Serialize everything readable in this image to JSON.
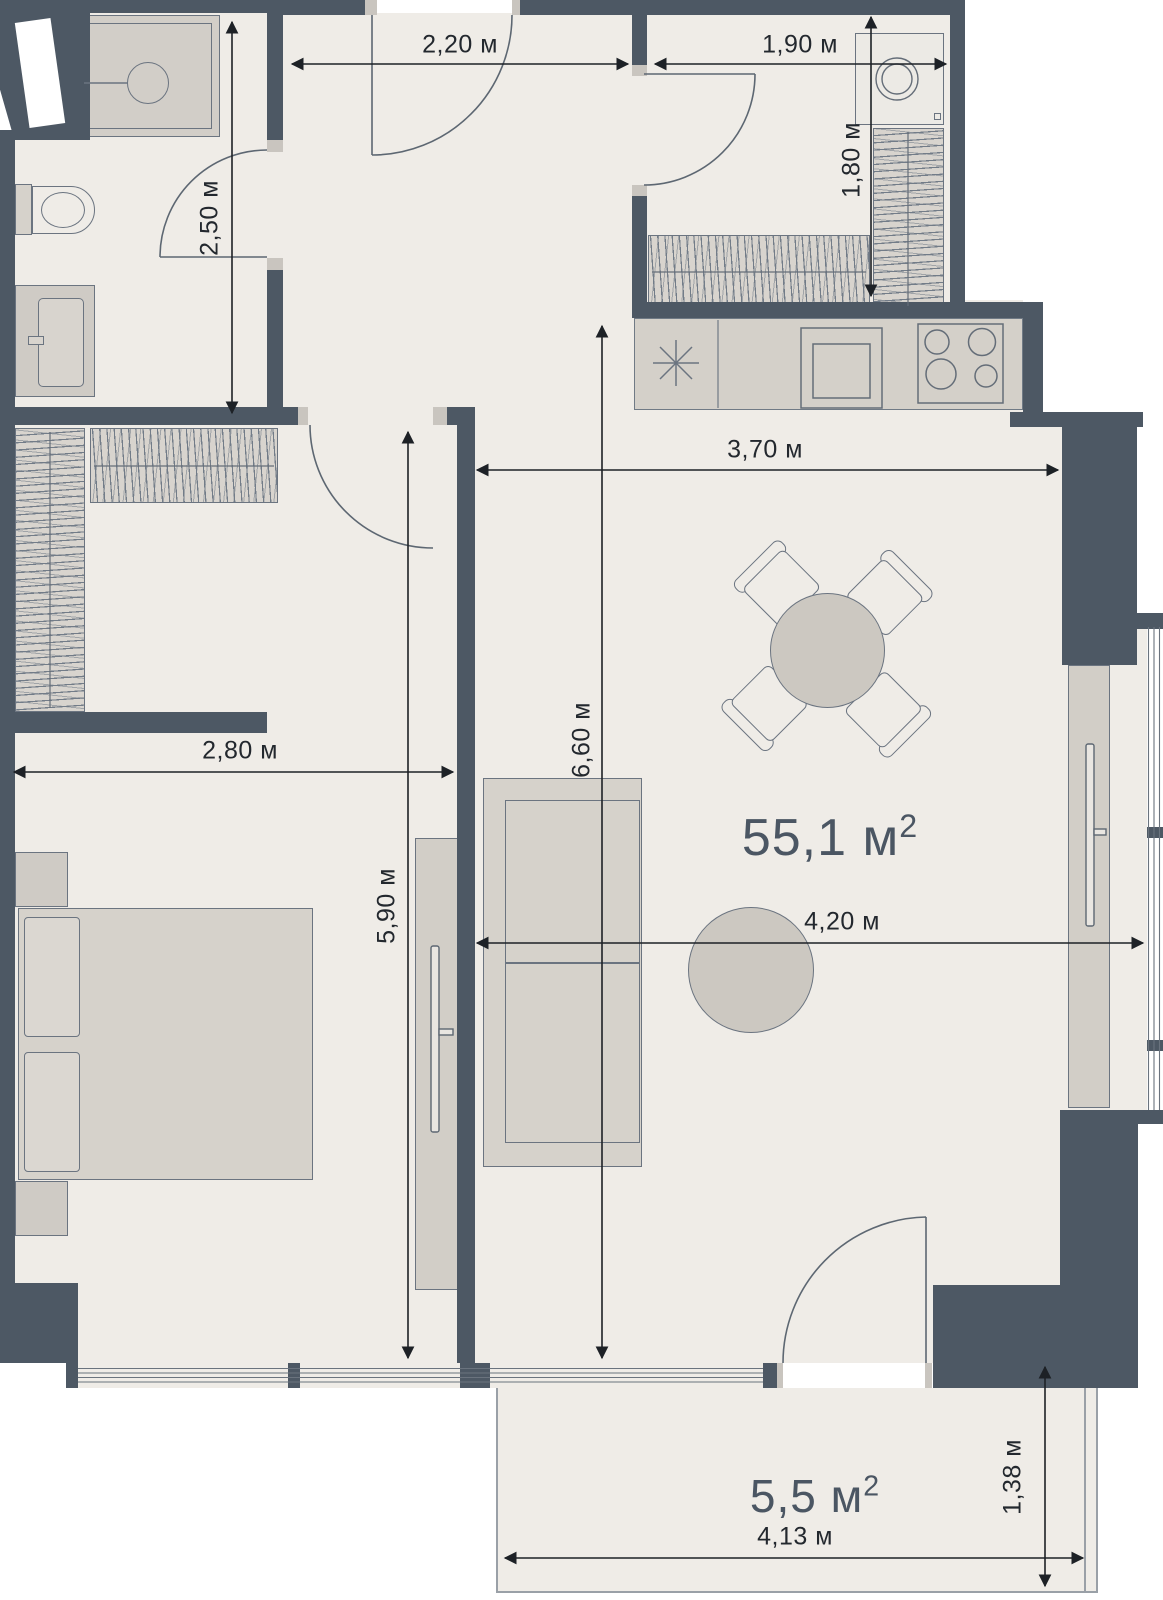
{
  "plan": {
    "title": "apartment-floor-plan",
    "area_labels": [
      {
        "id": "living-total-area",
        "text": "55,1 м",
        "sup": "2"
      },
      {
        "id": "balcony-area",
        "text": "5,5 м",
        "sup": "2"
      }
    ],
    "dimensions": [
      {
        "id": "hallway-width",
        "text": "2,20 м"
      },
      {
        "id": "laundry-width",
        "text": "1,90 м"
      },
      {
        "id": "bathroom-depth",
        "text": "2,50 м"
      },
      {
        "id": "laundry-depth",
        "text": "1,80 м"
      },
      {
        "id": "kitchen-width",
        "text": "3,70 м"
      },
      {
        "id": "living-depth",
        "text": "6,60 м"
      },
      {
        "id": "bedroom-width",
        "text": "2,80 м"
      },
      {
        "id": "bedroom-depth",
        "text": "5,90 м"
      },
      {
        "id": "living-width",
        "text": "4,20 м"
      },
      {
        "id": "balcony-width",
        "text": "4,13 м"
      },
      {
        "id": "balcony-depth",
        "text": "1,38 м"
      }
    ],
    "colors": {
      "wall": "#4d5864",
      "floor": "#efece7",
      "furniture_fill": "#d6d2cb",
      "label_text": "#4b5663",
      "dimension_text": "#23282e"
    },
    "icons": {
      "sink": "asterisk-star",
      "stove": "four-burner-circles",
      "shower": "square-with-round-head",
      "toilet": "tank-and-bowl",
      "washing_machine": "box-with-drum-circle",
      "wardrobe": "hatched-rail-strip",
      "door": "quarter-arc-swing",
      "window": "parallel-thin-lines"
    }
  }
}
